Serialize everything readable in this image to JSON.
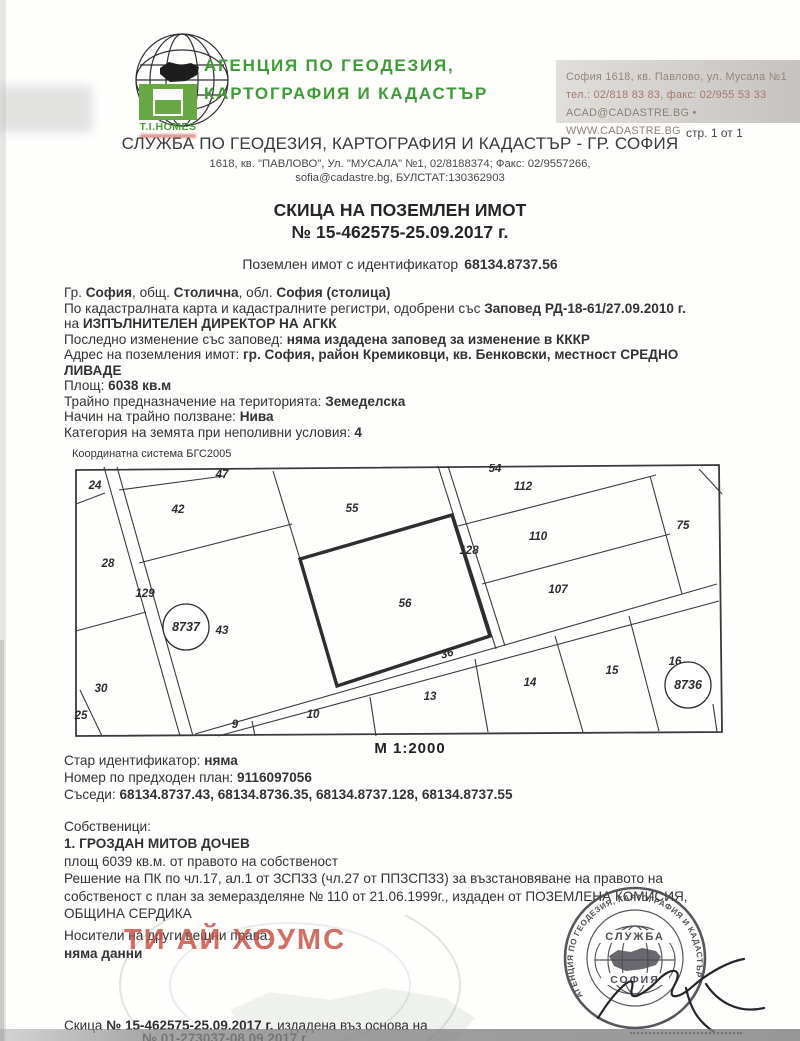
{
  "header": {
    "agency_line1": "АГЕНЦИЯ ПО ГЕОДЕЗИЯ,",
    "agency_line2": "КАРТОГРАФИЯ И КАДАСТЪР",
    "tihomes": "T.I.HOMES",
    "contact": [
      "София 1618, кв. Павлово, ул. Мусала №1",
      "тел.: 02/818 83 83, факс: 02/955 53 33",
      "ACAD@CADASTRE.BG • WWW.CADASTRE.BG"
    ],
    "pager": "стр. 1 от 1"
  },
  "office": {
    "title": "СЛУЖБА ПО ГЕОДЕЗИЯ, КАРТОГРАФИЯ И КАДАСТЪР - ГР. СОФИЯ",
    "address1": "1618, кв. \"ПАВЛОВО\", Ул. \"МУСАЛА\" №1, 02/8188374; Факс: 02/9557266,",
    "address2": "sofia@cadastre.bg, БУЛСТАТ:130362903"
  },
  "doc": {
    "title": "СКИЦА НА ПОЗЕМЛЕН ИМОТ",
    "number": "№ 15-462575-25.09.2017 г.",
    "id_label": "Поземлен имот с  идентификатор",
    "id_value": "68134.8737.56"
  },
  "details": {
    "lines": [
      [
        [
          "Гр. ",
          0
        ],
        [
          "София",
          1
        ],
        [
          ", общ. ",
          0
        ],
        [
          "Столична",
          1
        ],
        [
          ", обл. ",
          0
        ],
        [
          "София (столица)",
          1
        ]
      ],
      [
        [
          "По кадастралната карта и кадастралните регистри, одобрени със ",
          0
        ],
        [
          "Заповед РД-18-61/27.09.2010 г.",
          1
        ]
      ],
      [
        [
          "на ",
          0
        ],
        [
          "ИЗПЪЛНИТЕЛЕН ДИРЕКТОР НА АГКК",
          1
        ]
      ],
      [
        [
          "Последно изменение със заповед: ",
          0
        ],
        [
          "няма издадена заповед за изменение в КККР",
          1
        ]
      ],
      [
        [
          "Адрес на поземления имот: ",
          0
        ],
        [
          "гр. София, район Кремиковци, кв. Бенковски, местност СРЕДНО",
          1
        ]
      ],
      [
        [
          "ЛИВАДЕ",
          1
        ]
      ],
      [
        [
          "Площ: ",
          0
        ],
        [
          "6038 кв.м",
          1
        ]
      ],
      [
        [
          "Трайно предназначение на територията: ",
          0
        ],
        [
          "Земеделска",
          1
        ]
      ],
      [
        [
          "Начин на трайно ползване: ",
          0
        ],
        [
          "Нива",
          1
        ]
      ],
      [
        [
          "Категория на земята при неполивни условия: ",
          0
        ],
        [
          "4",
          1
        ]
      ]
    ]
  },
  "map": {
    "coord_system": "Координатна система БГС2005",
    "scale": "М 1:2000",
    "outer": [
      [
        4,
        6
      ],
      [
        647,
        1
      ],
      [
        650,
        268
      ],
      [
        4,
        272
      ]
    ],
    "bold_plot": [
      [
        228,
        95
      ],
      [
        380,
        51
      ],
      [
        418,
        172
      ],
      [
        265,
        222
      ]
    ],
    "lines": [
      [
        32,
        3,
        108,
        272,
        1.1
      ],
      [
        45,
        3,
        121,
        272,
        1.1
      ],
      [
        4,
        40,
        33,
        29,
        1.1
      ],
      [
        4,
        167,
        74,
        148,
        1.1
      ],
      [
        8,
        226,
        30,
        272,
        1.1
      ],
      [
        47,
        26,
        152,
        12,
        1.1
      ],
      [
        67,
        99,
        220,
        60,
        1.1
      ],
      [
        201,
        7,
        228,
        95,
        1.1
      ],
      [
        366,
        2,
        424,
        185,
        1.1
      ],
      [
        376,
        2,
        433,
        182,
        1.1
      ],
      [
        386,
        62,
        584,
        11,
        1.1
      ],
      [
        410,
        120,
        598,
        70,
        1.1
      ],
      [
        578,
        12,
        610,
        130,
        1.1
      ],
      [
        123,
        270,
        645,
        120,
        3
      ],
      [
        146,
        272,
        647,
        137,
        1.1
      ],
      [
        180,
        257,
        183,
        272,
        1.1
      ],
      [
        298,
        233,
        304,
        272,
        1.1
      ],
      [
        403,
        195,
        416,
        268,
        1.1
      ],
      [
        483,
        172,
        511,
        268,
        1.1
      ],
      [
        557,
        152,
        587,
        267,
        1.1
      ],
      [
        641,
        240,
        645,
        268,
        3
      ],
      [
        627,
        5,
        650,
        30,
        1.1
      ]
    ],
    "labels": [
      {
        "t": "24",
        "x": 23,
        "y": 25
      },
      {
        "t": "47",
        "x": 150,
        "y": 14
      },
      {
        "t": "42",
        "x": 106,
        "y": 49
      },
      {
        "t": "28",
        "x": 36,
        "y": 103
      },
      {
        "t": "129",
        "x": 73,
        "y": 133
      },
      {
        "t": "43",
        "x": 150,
        "y": 170
      },
      {
        "t": "30",
        "x": 29,
        "y": 228
      },
      {
        "t": "25",
        "x": 9,
        "y": 255
      },
      {
        "t": "55",
        "x": 280,
        "y": 48
      },
      {
        "t": "54",
        "x": 423,
        "y": 8
      },
      {
        "t": "56",
        "x": 333,
        "y": 143
      },
      {
        "t": "128",
        "x": 397,
        "y": 90
      },
      {
        "t": "112",
        "x": 451,
        "y": 26
      },
      {
        "t": "110",
        "x": 466,
        "y": 76
      },
      {
        "t": "107",
        "x": 486,
        "y": 129
      },
      {
        "t": "75",
        "x": 611,
        "y": 65
      },
      {
        "t": "36",
        "x": 376,
        "y": 193,
        "r": -16
      },
      {
        "t": "13",
        "x": 358,
        "y": 236
      },
      {
        "t": "10",
        "x": 241,
        "y": 254
      },
      {
        "t": "9",
        "x": 163,
        "y": 264
      },
      {
        "t": "14",
        "x": 458,
        "y": 222
      },
      {
        "t": "15",
        "x": 540,
        "y": 210
      },
      {
        "t": "16",
        "x": 603,
        "y": 201
      }
    ],
    "circles": [
      {
        "t": "8737",
        "x": 114,
        "y": 163,
        "r": 23
      },
      {
        "t": "8736",
        "x": 616,
        "y": 221,
        "r": 23
      }
    ]
  },
  "info": {
    "lines": [
      [
        [
          "Стар идентификатор: ",
          0
        ],
        [
          "няма",
          1
        ]
      ],
      [
        [
          "Номер по предходен план: ",
          0
        ],
        [
          "9116097056",
          1
        ]
      ],
      [
        [
          "Съседи: ",
          0
        ],
        [
          "68134.8737.43, 68134.8736.35, 68134.8737.128, 68134.8737.55",
          1
        ]
      ]
    ]
  },
  "owners": {
    "lines": [
      [
        [
          "Собственици:",
          0
        ]
      ],
      [
        [
          "1. ГРОЗДАН МИТОВ ДОЧЕВ",
          1
        ]
      ],
      [
        [
          "площ 6039 кв.м. от правото на собственост",
          0
        ]
      ],
      [
        [
          "Решение на ПК по чл.17, ал.1 от ЗСПЗЗ (чл.27 от ППЗСПЗЗ) за възстановяване на правото на",
          0
        ]
      ],
      [
        [
          "собственост с план за земеразделяне № 110 от 21.06.1999г., издаден от ПОЗЕМЛЕНА КОМИСИЯ,",
          0
        ]
      ],
      [
        [
          "ОБЩИНА СЕРДИКА",
          0
        ]
      ]
    ]
  },
  "rights": {
    "title": "Носители на други вещни права:",
    "value": "няма данни"
  },
  "watermark": {
    "text": "ТИ АЙ ХОУМС",
    "color": "#c94d42"
  },
  "stamp": {
    "ring_text": "АГЕНЦИЯ ПО ГЕОДЕЗИЯ, КАРТОГРАФИЯ И КАДАСТЪР",
    "top": "СЛУЖБА",
    "bottom": "СОФИЯ"
  },
  "footer": {
    "line1": [
      [
        "Скица ",
        0
      ],
      [
        "№ 15-462575-25.09.2017 г.",
        1
      ],
      [
        " издадена въз основа на",
        0
      ]
    ],
    "line2": [
      [
        "№ 01-273037-08.09.2017 г.",
        1
      ]
    ]
  },
  "colors": {
    "green": "#3f9b37"
  }
}
